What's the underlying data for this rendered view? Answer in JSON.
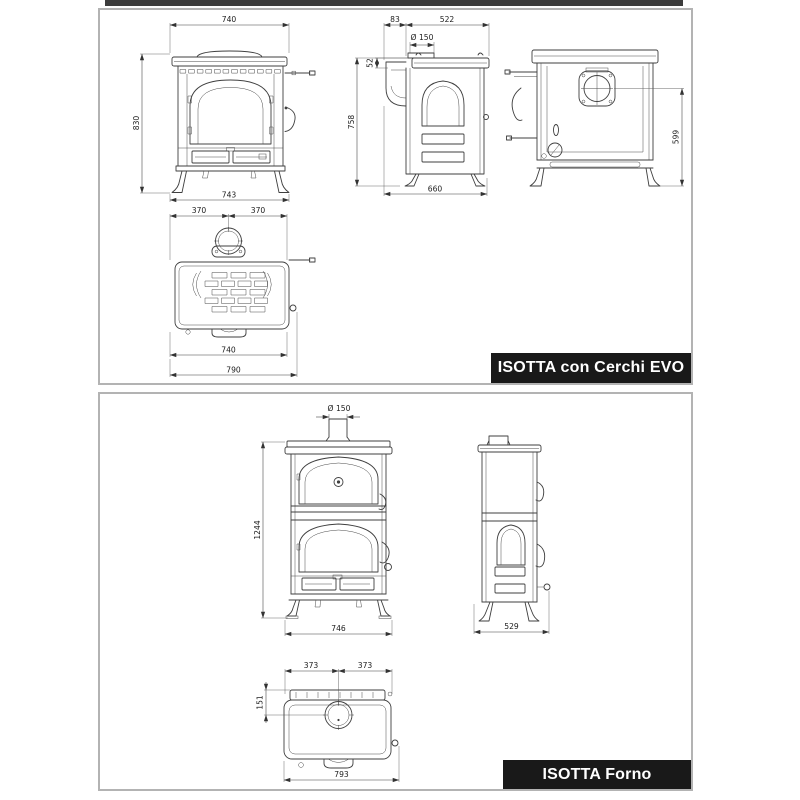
{
  "document": {
    "type": "stove-dimension-sheet"
  },
  "colors": {
    "line": "#3f3f3f",
    "label_bg": "#191919",
    "label_text": "#ffffff",
    "panel_border": "#b3b3b3",
    "top_bar": "#3c3c3c",
    "background": "#ffffff"
  },
  "panels": [
    {
      "label": "ISOTTA con Cerchi EVO",
      "dims": {
        "front_width_top": "740",
        "front_height": "830",
        "front_width_bottom": "743",
        "side_back_offset": "83",
        "side_depth_body": "522",
        "side_flue_diameter": "Ø 150",
        "side_flue_drop": "52",
        "side_height": "758",
        "side_depth_total": "660",
        "rear_flue_height": "599",
        "top_half_left": "370",
        "top_half_right": "370",
        "top_plate_width": "740",
        "top_total_width": "790"
      }
    },
    {
      "label": "ISOTTA Forno",
      "dims": {
        "front_flue_diameter": "Ø 150",
        "front_height": "1244",
        "front_width": "746",
        "side_depth": "529",
        "top_half_left": "373",
        "top_half_right": "373",
        "top_flue_offset": "151",
        "top_width": "793"
      }
    }
  ]
}
